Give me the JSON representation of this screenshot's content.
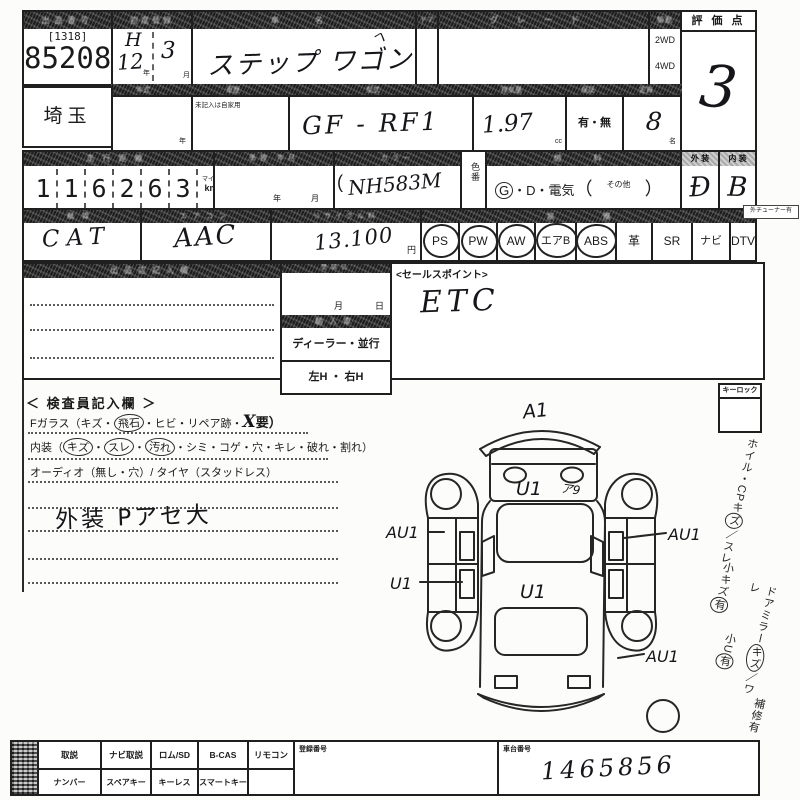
{
  "colors": {
    "ink": "#1a1a1a",
    "bar": "#1d1d1d",
    "hand": "#15151a"
  },
  "row1": {
    "lot_header": "出品番号",
    "lot_bracket": "[1318]",
    "lot_number": "85208",
    "date_header": "初度登録",
    "era": "H",
    "year": "12",
    "year_unit": "年",
    "month": "3",
    "month_unit": "月",
    "name_header": "車　名",
    "car_name": "ステップ ワゴン",
    "stray_mark": "ヘ",
    "door_header": "ドア",
    "grade_header": "グレード",
    "drive_header": "駆動",
    "drive_2wd": "2WD",
    "drive_4wd": "4WD",
    "score_header": "評 価 点",
    "score": "3"
  },
  "row2": {
    "region": "埼玉",
    "header_year": "年式",
    "header_history": "車歴",
    "header_model": "型式",
    "header_disp": "排気量",
    "header_warranty": "保証",
    "header_capacity": "定員",
    "year_unit": "年",
    "private_note": "未記入は自家用",
    "model": "GF - RF1",
    "displacement": "1.97",
    "disp_unit": "cc",
    "warranty": "有・無",
    "capacity": "8",
    "capacity_unit": "名"
  },
  "row3": {
    "header_mileage": "走行距離",
    "header_inspection": "車検 年月",
    "header_color": "カラー",
    "header_fuel": "燃　料",
    "header_exterior": "外 装",
    "header_interior": "内 装",
    "mileage_digits": [
      "1",
      "1",
      "6",
      "2",
      "6",
      "3"
    ],
    "unit_top": "マイル",
    "unit_bottom": "km",
    "insp_year": "年",
    "insp_month": "月",
    "paren": "(",
    "color_code": "NH583M",
    "color_label": "色番",
    "fuel_g": "G",
    "fuel_sep1": "・",
    "fuel_d": "D",
    "fuel_sep2": "・",
    "fuel_elec": "電気",
    "fuel_open": "（",
    "fuel_other": "その他",
    "fuel_close": "）",
    "exterior": "Đ",
    "interior": "B"
  },
  "row4": {
    "header_cat": "触媒",
    "header_ac": "エアコン",
    "header_recycle": "リサイクル料",
    "header_equip": "装　備",
    "cat": "CAT",
    "ac": "AAC",
    "recycle": "13.100",
    "yen": "円",
    "equipment": [
      {
        "label": "PS"
      },
      {
        "label": "PW"
      },
      {
        "label": "AW"
      },
      {
        "label": "エアB"
      },
      {
        "label": "ABS"
      },
      {
        "label": "革"
      },
      {
        "label": "SR"
      },
      {
        "label": "ナビ"
      },
      {
        "label": "DTV"
      }
    ],
    "tuner_note": "外チューナー有"
  },
  "row5": {
    "left_header": "出品店記入欄",
    "date_header": "登録日",
    "month": "月",
    "day": "日",
    "import_label": "輸入車",
    "dealer_label": "ディーラー・並行",
    "handle_label": "左H ・ 右H",
    "sales_label": "<セールスポイント>",
    "sales_value": "ETC",
    "keylock_label": "キーロック"
  },
  "inspector": {
    "title": "＜ 検査員記入欄 ＞",
    "l1a": "Fガラス（キズ・",
    "l1c": "飛石",
    "l1b": "・ヒビ・リペア跡・",
    "l1x": "X",
    "l1d": "要）",
    "l2a": "内装（",
    "l2c1": "キズ",
    "l2s1": "・",
    "l2c2": "スレ",
    "l2s2": "・",
    "l2c3": "汚れ",
    "l2b": "・シミ・コゲ・穴・キレ・破れ・割れ）",
    "l3": "オーディオ（無し・穴）/ タイヤ（スタッドレス）",
    "note": "外装 Pアセ大"
  },
  "diagram": {
    "front": "A1",
    "hood": "U1",
    "hood_note": "ア9",
    "left": "AU1",
    "right": "AU1",
    "left_lower": "U1",
    "roof": "U1",
    "rear_right": "AU1"
  },
  "margin": {
    "m1a": "ホイル・CPキ",
    "m1c": "ズ",
    "m1b": "／スレ",
    "m2a": "小キズ",
    "m2c": "有",
    "m3a": "ドアミラー",
    "m3c": "キズ",
    "m3b": "／ワレ",
    "m4a": "小U",
    "m4c": "有",
    "m5": "補修有"
  },
  "bottom": {
    "top_cells": [
      "取説",
      "ナビ取説",
      "ロム/SD",
      "B-CAS",
      "リモコン"
    ],
    "bottom_cells": [
      "ナンバー",
      "スペアキー",
      "キーレス",
      "スマートキー"
    ],
    "reg_label": "登録番号",
    "chassis_label": "車台番号",
    "chassis_value": "1465856"
  }
}
